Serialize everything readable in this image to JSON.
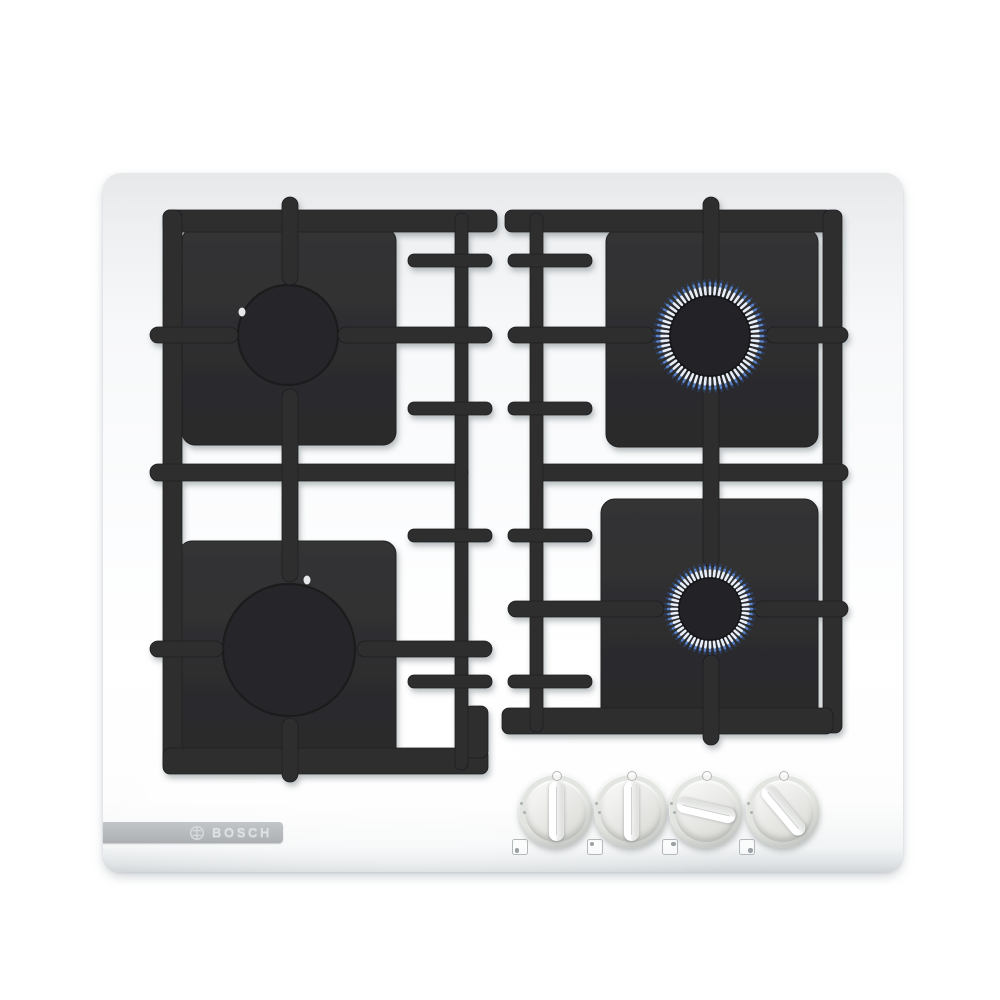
{
  "product": {
    "brand": "BOSCH",
    "badge_text": "BOSCH",
    "type": "4-burner gas hob, white glass"
  },
  "colors": {
    "surface_top": "#e6e8ea",
    "surface_mid": "#fbfcfd",
    "surface_white": "#ffffff",
    "grate": "#2d2d2f",
    "grate_dark": "#1e1e20",
    "plate_light": "#323234",
    "plate_dark": "#2a2a2c",
    "flame_base": "#e9eff9",
    "flame_mid": "#5c85c9",
    "flame_tip": "#31508c",
    "badge_bg": "#b7bbbe",
    "badge_text_color": "#dfe2e4",
    "edge_line": "#cfd4d6",
    "knob_face": "#e9eae6",
    "icon_gray": "#b3b8bb"
  },
  "burners": [
    {
      "id": "back-left",
      "lit": false,
      "cx": 288,
      "cy": 335,
      "r": 50,
      "highlight": {
        "dx": -46,
        "dy": -23
      }
    },
    {
      "id": "front-left",
      "lit": false,
      "cx": 289,
      "cy": 650,
      "r": 66,
      "highlight": {
        "dx": 18,
        "dy": -70
      }
    },
    {
      "id": "back-right",
      "lit": true,
      "cx": 710,
      "cy": 336,
      "r": 42,
      "flame": {
        "r_inner": 42,
        "r_outer": 53,
        "ticks": 60
      }
    },
    {
      "id": "front-right",
      "lit": true,
      "cx": 710,
      "cy": 609,
      "r": 33,
      "flame": {
        "r_inner": 33,
        "r_outer": 42,
        "ticks": 52
      }
    }
  ],
  "knobs": [
    {
      "id": "knob-front-left",
      "cx": 556,
      "cy": 811,
      "angle_deg": 0,
      "state": "off",
      "burner": "front-left",
      "icon_dot": "bottom-left"
    },
    {
      "id": "knob-back-left",
      "cx": 631,
      "cy": 811,
      "angle_deg": 0,
      "state": "off",
      "burner": "back-left",
      "icon_dot": "top-left"
    },
    {
      "id": "knob-back-right",
      "cx": 706,
      "cy": 811,
      "angle_deg": -77,
      "state": "on",
      "burner": "back-right",
      "icon_dot": "top-right"
    },
    {
      "id": "knob-front-right",
      "cx": 783,
      "cy": 811,
      "angle_deg": -40,
      "state": "on",
      "burner": "front-right",
      "icon_dot": "bottom-right"
    }
  ]
}
